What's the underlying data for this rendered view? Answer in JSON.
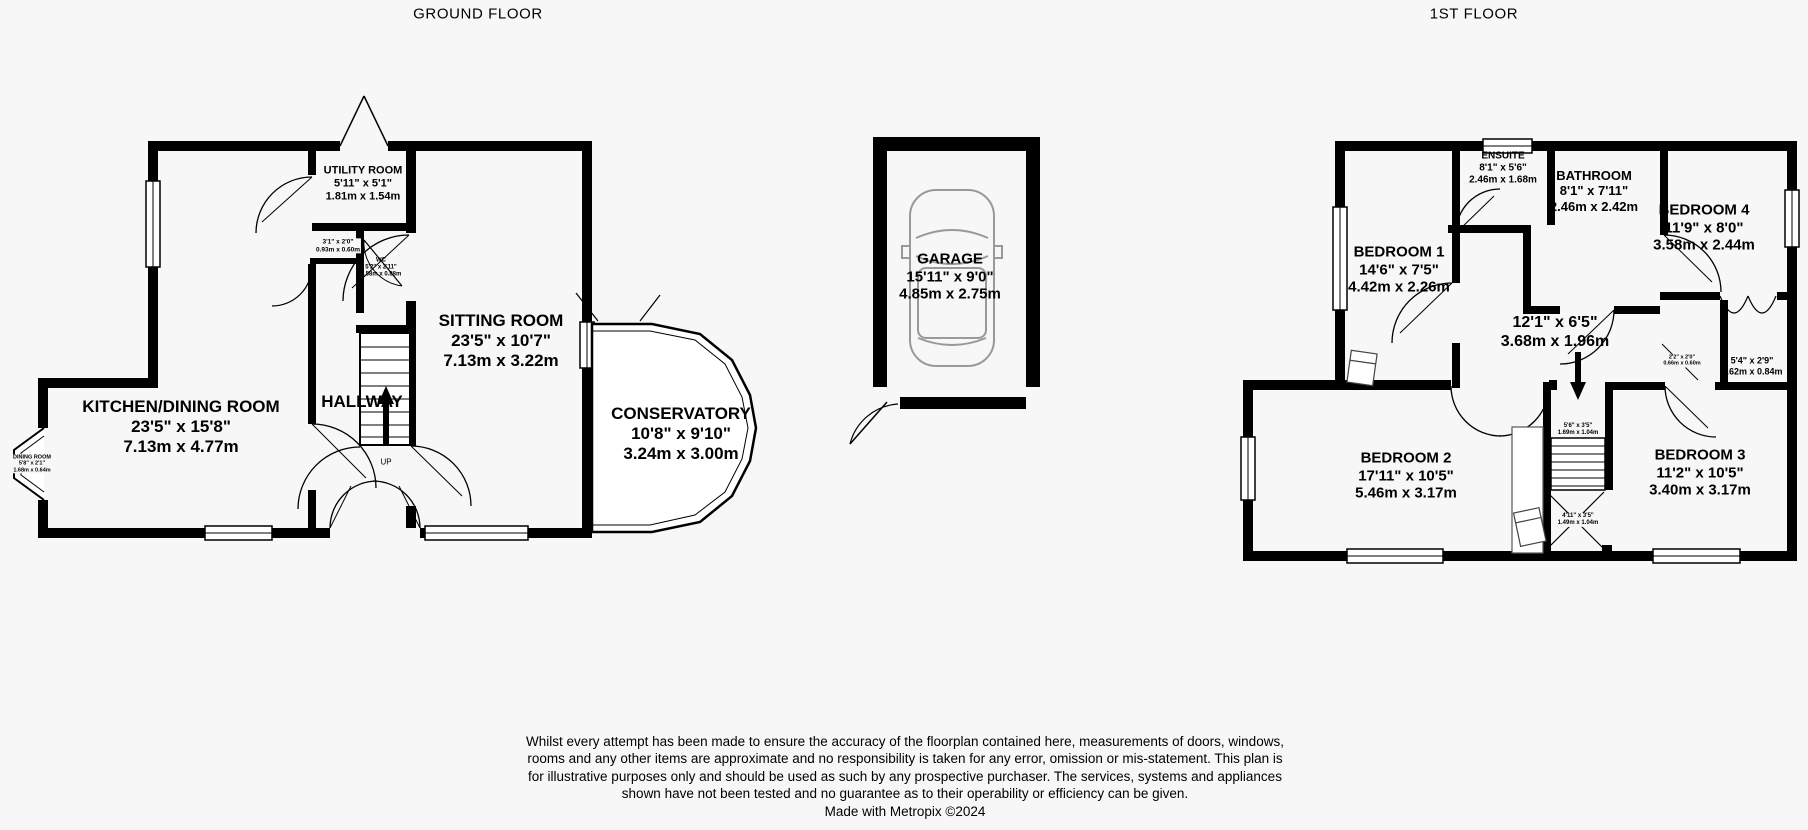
{
  "colors": {
    "background": "#f7f7f7",
    "ink": "#000000",
    "car_outline": "#999999"
  },
  "ground_floor": {
    "title": "GROUND FLOOR",
    "rooms": {
      "utility": {
        "name": "UTILITY ROOM",
        "imperial": "5'11\" x 5'1\"",
        "metric": "1.81m x 1.54m"
      },
      "sitting": {
        "name": "SITTING ROOM",
        "imperial": "23'5\" x 10'7\"",
        "metric": "7.13m x 3.22m"
      },
      "kitchen_dining": {
        "name": "KITCHEN/DINING ROOM",
        "imperial": "23'5\" x 15'8\"",
        "metric": "7.13m x 4.77m"
      },
      "hallway": {
        "name": "HALLWAY"
      },
      "conservatory": {
        "name": "CONSERVATORY",
        "imperial": "10'8\" x 9'10\"",
        "metric": "3.24m x 3.00m"
      },
      "wc": {
        "name": "WC",
        "imperial": "5'2\" x 2'11\"",
        "metric": "1.58m x 0.88m"
      },
      "cupboard": {
        "imperial": "3'1\" x 2'0\"",
        "metric": "0.93m x 0.60m"
      },
      "dining_bay": {
        "name": "DINING ROOM",
        "imperial": "5'8\" x 2'1\"",
        "metric": "1.68m x 0.64m"
      },
      "stairs_direction": "UP"
    },
    "garage": {
      "name": "GARAGE",
      "imperial": "15'11\" x 9'0\"",
      "metric": "4.85m x 2.75m"
    }
  },
  "first_floor": {
    "title": "1ST FLOOR",
    "rooms": {
      "bedroom1": {
        "name": "BEDROOM 1",
        "imperial": "14'6\" x 7'5\"",
        "metric": "4.42m x 2.26m"
      },
      "ensuite": {
        "name": "ENSUITE",
        "imperial": "8'1\" x 5'6\"",
        "metric": "2.46m x 1.68m"
      },
      "bathroom": {
        "name": "BATHROOM",
        "imperial": "8'1\" x 7'11\"",
        "metric": "2.46m x 2.42m"
      },
      "bedroom4": {
        "name": "BEDROOM 4",
        "imperial": "11'9\" x 8'0\"",
        "metric": "3.58m x 2.44m"
      },
      "landing": {
        "imperial": "12'1\" x 6'5\"",
        "metric": "3.68m x 1.96m"
      },
      "bedroom2": {
        "name": "BEDROOM 2",
        "imperial": "17'11\" x 10'5\"",
        "metric": "5.46m x 3.17m"
      },
      "bedroom3": {
        "name": "BEDROOM 3",
        "imperial": "11'2\" x 10'5\"",
        "metric": "3.40m x 3.17m"
      },
      "closet": {
        "imperial": "5'4\" x 2'9\"",
        "metric": "1.62m x 0.84m"
      },
      "stairs_upper": {
        "imperial": "5'6\" x 3'5\"",
        "metric": "1.69m x 1.04m"
      },
      "stairs_lower": {
        "imperial": "4'11\" x 3'5\"",
        "metric": "1.49m x 1.04m"
      },
      "cupboard": {
        "imperial": "2'2\" x 2'0\"",
        "metric": "0.66m x 0.60m"
      }
    }
  },
  "footer": {
    "disclaimer": "Whilst every attempt has been made to ensure the accuracy of the floorplan contained here, measurements of doors, windows, rooms and any other items are approximate and no responsibility is taken for any error, omission or mis-statement. This plan is for illustrative purposes only and should be used as such by any prospective purchaser. The services, systems and appliances shown have not been tested and no guarantee as to their operability or efficiency can be given.",
    "credit": "Made with Metropix ©2024"
  }
}
